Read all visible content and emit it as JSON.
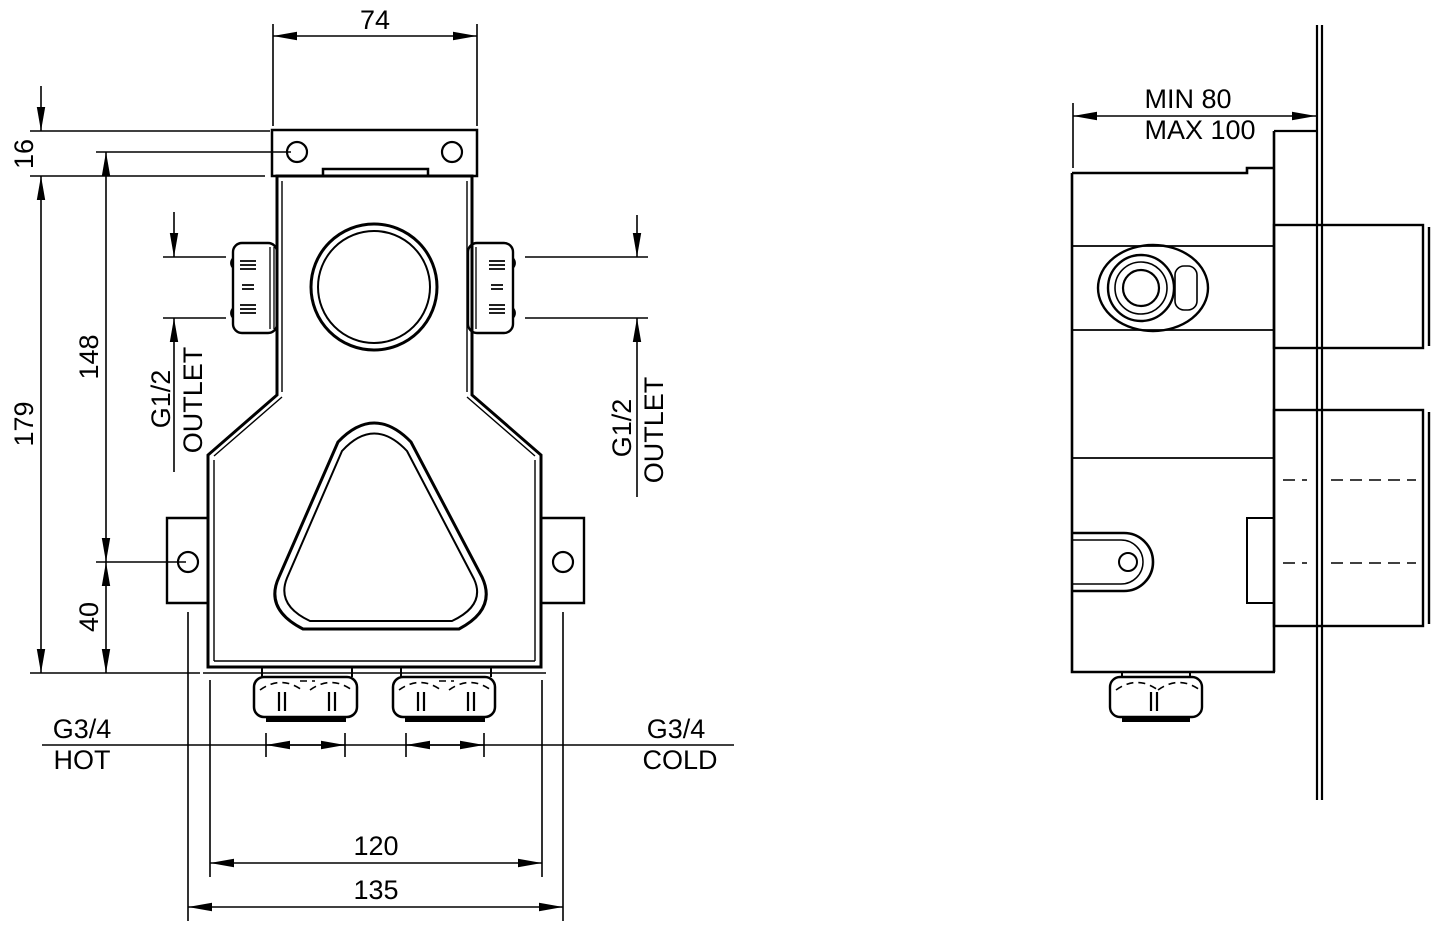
{
  "front_view": {
    "dim_top_width": "74",
    "dim_bracket_offset": "16",
    "dim_body_height": "179",
    "dim_hole_spacing": "148",
    "dim_tab_to_bottom": "40",
    "dim_inlet_span": "120",
    "dim_tab_hole_span": "135",
    "outlet_left": {
      "thread": "G1/2",
      "label": "OUTLET"
    },
    "outlet_right": {
      "thread": "G1/2",
      "label": "OUTLET"
    },
    "inlet_hot": {
      "thread": "G3/4",
      "label": "HOT"
    },
    "inlet_cold": {
      "thread": "G3/4",
      "label": "COLD"
    }
  },
  "side_view": {
    "dim_depth_min": "MIN 80",
    "dim_depth_max": "MAX 100"
  },
  "colors": {
    "line": "#000000",
    "background": "#ffffff"
  }
}
